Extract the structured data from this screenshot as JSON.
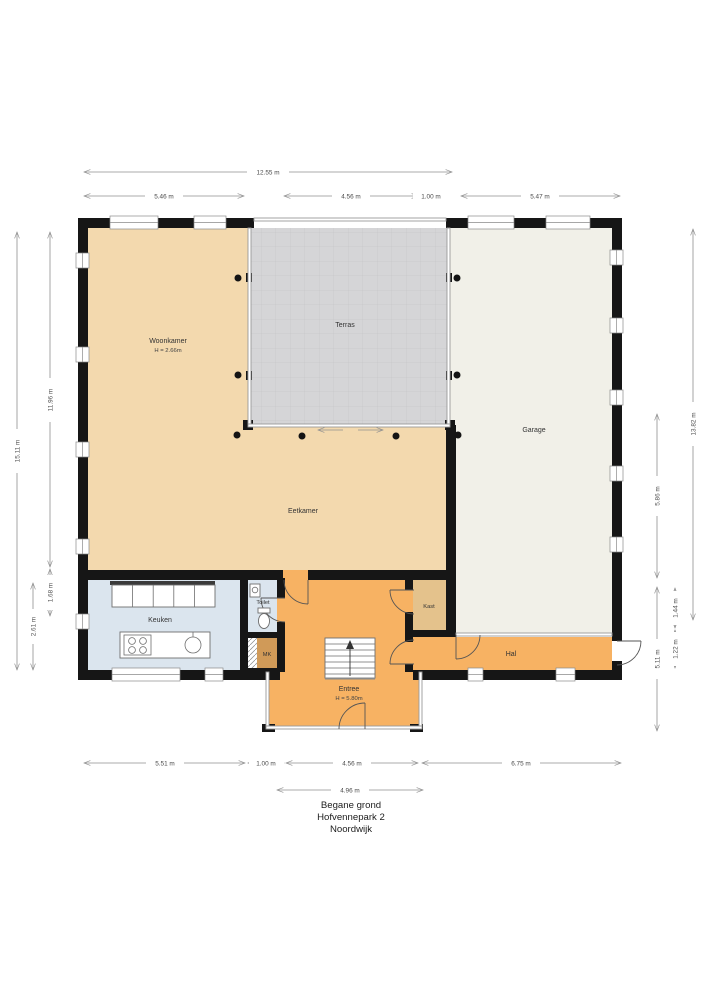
{
  "plan_title": {
    "line1": "Begane grond",
    "line2": "Hofvennepark 2",
    "line3": "Noordwijk"
  },
  "rooms": {
    "woonkamer": {
      "name": "Woonkamer",
      "height": "H = 2.66m"
    },
    "terras": {
      "name": "Terras"
    },
    "garage": {
      "name": "Garage"
    },
    "eetkamer": {
      "name": "Eetkamer"
    },
    "keuken": {
      "name": "Keuken"
    },
    "toilet": {
      "name": "Toilet"
    },
    "mk": {
      "name": "MK"
    },
    "kast": {
      "name": "Kast"
    },
    "entree": {
      "name": "Entree",
      "height": "H = 5.80m"
    },
    "hal": {
      "name": "Hal"
    }
  },
  "dimensions": {
    "top": [
      "12.55 m",
      "5.46 m",
      "4.56 m",
      "1.00 m",
      "5.47 m"
    ],
    "bottom": [
      "5.51 m",
      "1.00 m",
      "4.56 m",
      "6.75 m",
      "4.96 m"
    ],
    "left": [
      "15.11 m",
      "11.96 m",
      "1.68 m",
      "2.61 m"
    ],
    "right": [
      "13.82 m",
      "5.86 m",
      "5.11 m",
      "1.44 m",
      "1.22 m"
    ]
  },
  "colors": {
    "living": "#f3d9ae",
    "terras": "#d5d5d7",
    "terras_grid": "#c6c6c9",
    "garage": "#f1f0e8",
    "keuken": "#dbe5ee",
    "entree": "#f7b263",
    "kast": "#e4c28c",
    "mk": "#d09a58"
  }
}
